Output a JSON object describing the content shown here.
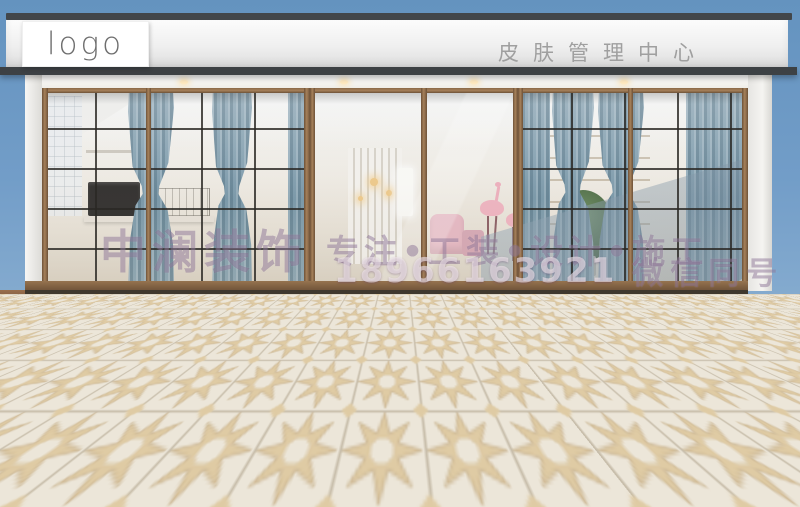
{
  "scene": {
    "description": "3D render of a skin management center storefront with glass facade, blue curtains and star-pattern tiled plaza",
    "sign": {
      "logo_text": "logo",
      "store_name": "皮肤管理中心"
    },
    "watermark": {
      "company": "中澜装饰",
      "tagline": "专注•工装•设计•施工",
      "phone": "18966163921",
      "wechat_note": "微信同号"
    },
    "colors": {
      "sky_top": "#6493bf",
      "sky_bottom": "#a9c4d8",
      "roof_trim": "#42464a",
      "fascia": "#efefef",
      "frame_bronze": "#8a6848",
      "mullion": "#2a2824",
      "curtain_blue": "#7c9aab",
      "interior_warm": "#f4f0e9",
      "floor_base": "#ece6d9",
      "floor_star": "#dfcba4",
      "floor_line": "#8d7c5e",
      "watermark_purple": "rgba(96,64,110,0.36)"
    }
  }
}
